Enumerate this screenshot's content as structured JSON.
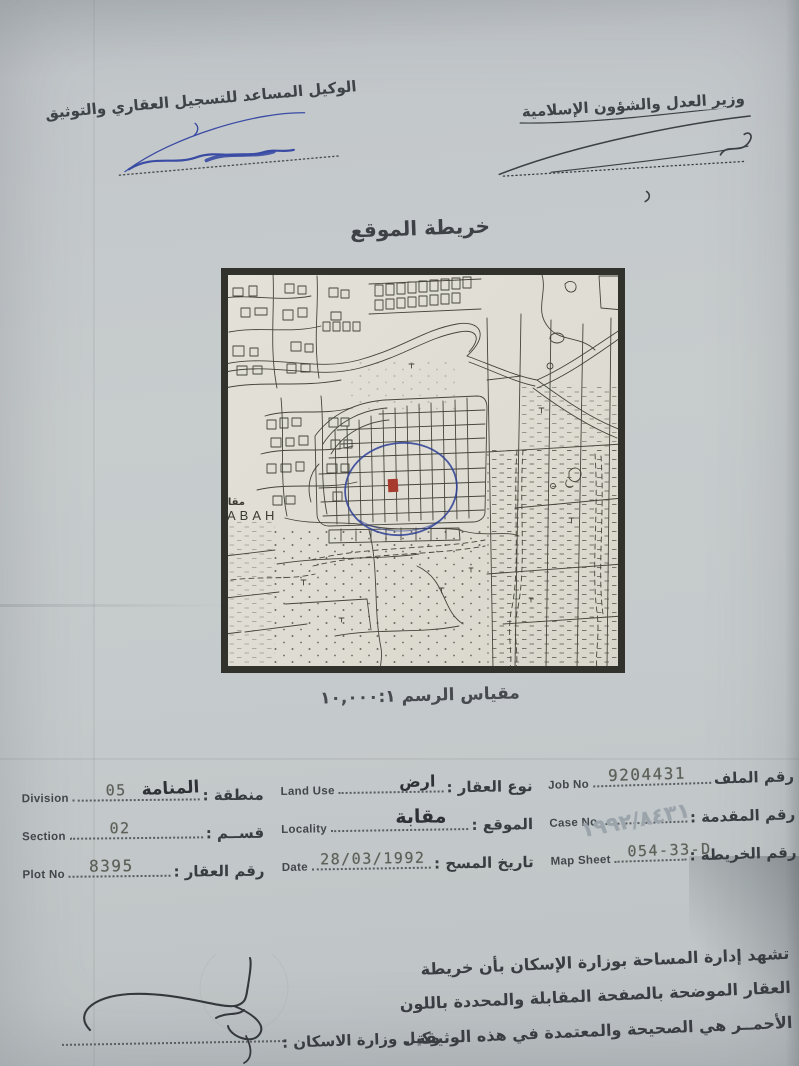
{
  "header": {
    "assistant_agent_title": "الوكيل المساعد للتسجيل العقاري والتوثيق",
    "minister_title": "وزير العدل والشؤون الإسلامية"
  },
  "map": {
    "title": "خريطة الموقع",
    "scale_label": "مقياس الرسم ١٠,٠٠٠:١",
    "village_label_latin": "ABAH",
    "village_label_arabic": "مقابة"
  },
  "fields": {
    "division": {
      "en": "Division",
      "ar": "منطقة :",
      "typed": "05",
      "written": "المنامة"
    },
    "section": {
      "en": "Section",
      "ar": "قســم :",
      "typed": "02"
    },
    "plot_no": {
      "en": "Plot No",
      "ar": "رقم العقار :",
      "typed": "8395"
    },
    "land_use": {
      "en": "Land Use",
      "ar": "نوع العقار :",
      "written": "ارض"
    },
    "locality": {
      "en": "Locality",
      "ar": "الموقع :",
      "written": "مقابة"
    },
    "date": {
      "en": "Date",
      "ar": "تاريخ المسح :",
      "typed": "28/03/1992"
    },
    "job_no": {
      "en": "Job No",
      "ar": "رقم الملف",
      "typed": "9204431"
    },
    "case_no": {
      "en": "Case No",
      "ar": "رقم المقدمة :",
      "written": "١٩٩٢/٨٤٣١"
    },
    "map_sheet": {
      "en": "Map Sheet",
      "ar": "رقم الخريطة :",
      "typed": "054-33-D"
    }
  },
  "attestation": {
    "lines": [
      "تشهد إدارة المساحة بوزارة الإسكان بأن خريطة",
      "العقار الموضحة بالصفحة المقابلة والمحددة باللون",
      "الأحمــر هي الصحيحة والمعتمدة في هذه الوثيقة ."
    ]
  },
  "footer": {
    "housing_undersecretary_label": "وكيل وزارة الاسكان :"
  },
  "colors": {
    "paper": "#c5cacc",
    "map_paper": "#e1dfd5",
    "dark_ink": "#3c4145",
    "blue_ink": "#3a4ba4",
    "typed_ink": "#5d6059",
    "pencil_ink": "#9ba3ab",
    "red_plot_marker": "#a63b2e"
  }
}
